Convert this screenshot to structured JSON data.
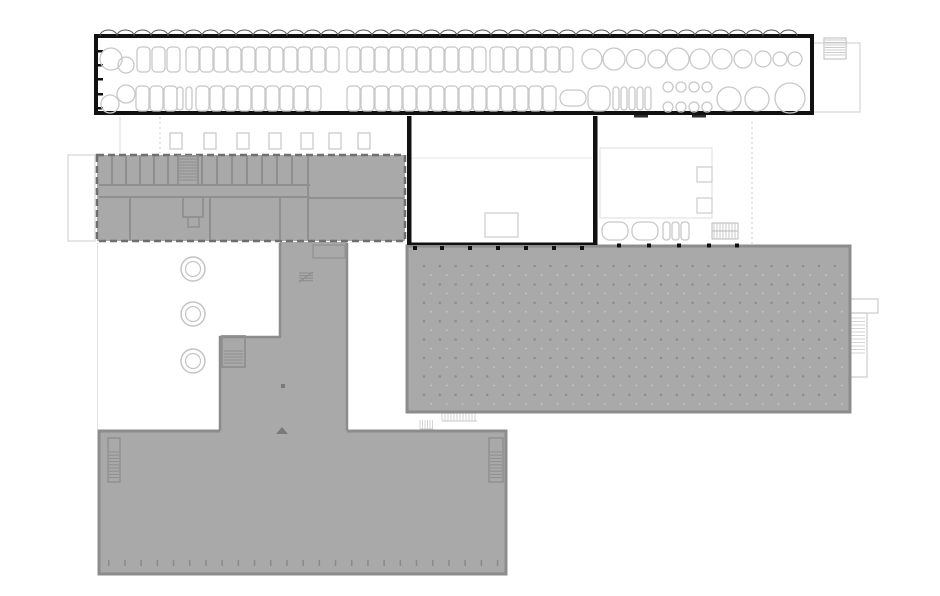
{
  "canvas": {
    "width": 940,
    "height": 596,
    "background": "#ffffff"
  },
  "palette": {
    "bg": "#ffffff",
    "fill_gray": "#a9a9a9",
    "wall_gray": "#8f8f8f",
    "border_gray": "#8c8c8c",
    "dark_dash": "#6f6f6f",
    "black": "#111111",
    "light": "#c8c8c8",
    "faint": "#dedede",
    "dot": "#8e8e8e",
    "dot2": "#c6c6c6",
    "marker": "#7a7a7a"
  },
  "layers": [
    {
      "name": "site-faint-outlines",
      "items": [
        [
          "rect",
          68,
          155,
          27,
          86,
          "#d4d4d4",
          1.2,
          "none"
        ],
        [
          "line",
          97.5,
          243,
          97.5,
          430,
          "#e2e2e2",
          1
        ],
        [
          "line",
          120,
          117,
          120,
          153,
          "#dddddd",
          1
        ],
        [
          "dline",
          160,
          117,
          160,
          153,
          "#cccccc",
          1
        ],
        [
          "sqrow",
          [
            170,
            204,
            237,
            269,
            301,
            329,
            358
          ],
          133,
          12,
          16,
          "#c6c6c6",
          1.2
        ],
        [
          "line",
          409,
          158,
          592,
          158,
          "#e6e6e6",
          1
        ],
        [
          "rect",
          485,
          213,
          33,
          24,
          "#cccccc",
          1.2,
          "none"
        ],
        [
          "rect",
          600,
          148,
          112,
          70,
          "#dddddd",
          1,
          "none"
        ],
        [
          "rect",
          697,
          167,
          15,
          15,
          "#cccccc",
          1.2,
          "none"
        ],
        [
          "rect",
          697,
          198,
          15,
          15,
          "#cccccc",
          1.2,
          "none"
        ],
        [
          "rr",
          602,
          222,
          26,
          18,
          8,
          "#c8c8c8",
          1.3
        ],
        [
          "rr",
          632,
          222,
          26,
          18,
          8,
          "#c8c8c8",
          1.3
        ],
        [
          "rr",
          663,
          222,
          7,
          18,
          3,
          "#c8c8c8",
          1.3
        ],
        [
          "rr",
          672,
          222,
          7,
          18,
          3,
          "#c8c8c8",
          1.3
        ],
        [
          "rr",
          681,
          222,
          8,
          18,
          3,
          "#c8c8c8",
          1.3
        ],
        [
          "rect",
          712,
          223,
          26,
          16,
          "#bbbbbb",
          1,
          "none"
        ],
        [
          "vlines",
          714,
          736,
          3,
          223,
          239,
          "#bbbbbb",
          0.8
        ],
        [
          "line",
          712,
          231,
          738,
          231,
          "#bbbbbb",
          1
        ],
        [
          "dline",
          752,
          122,
          752,
          244,
          "#c8c8c8",
          1
        ],
        [
          "rect",
          812,
          43,
          48,
          69,
          "#d4d4d4",
          1.2,
          "none"
        ],
        [
          "rect",
          824,
          38,
          22,
          21,
          "#bbbbbb",
          1,
          "none"
        ],
        [
          "rungs",
          825,
          845,
          40,
          57,
          2.5,
          "#bbbbbb",
          0.8
        ],
        [
          "rect",
          848,
          299,
          30,
          14,
          "#cccccc",
          1.2,
          "none"
        ],
        [
          "rect",
          848,
          313,
          19,
          64,
          "#cccccc",
          1.2,
          "none"
        ],
        [
          "rungs",
          850,
          865,
          318,
          356,
          3.5,
          "#cccccc",
          0.8
        ],
        [
          "vlines",
          420,
          433,
          2.5,
          420,
          429,
          "#c9c9c9",
          0.8
        ],
        [
          "line",
          420,
          429,
          433,
          429,
          "#c9c9c9",
          1
        ],
        [
          "vlines",
          442,
          477,
          3,
          412,
          421,
          "#c9c9c9",
          0.8
        ],
        [
          "line",
          442,
          412.5,
          477,
          412.5,
          "#c9c9c9",
          1
        ],
        [
          "line",
          442,
          421,
          477,
          421,
          "#c9c9c9",
          1
        ]
      ]
    },
    {
      "name": "south-hall",
      "items": [
        [
          "rect",
          99,
          431,
          407,
          143,
          "#8c8c8c",
          3,
          "#a9a9a9"
        ],
        [
          "rect",
          108,
          438,
          12,
          44,
          "#8f8f8f",
          1.5,
          "none"
        ],
        [
          "rungs",
          109,
          119,
          452,
          479,
          3.2,
          "#8f8f8f",
          1
        ],
        [
          "rect",
          489,
          438,
          14,
          44,
          "#8f8f8f",
          1.5,
          "none"
        ],
        [
          "rungs",
          490,
          502,
          452,
          480,
          3.2,
          "#8f8f8f",
          1
        ],
        [
          "vticks",
          108,
          16.2,
          25,
          560,
          6,
          1.5,
          "#8a8a8a"
        ]
      ]
    },
    {
      "name": "east-production-hall",
      "items": [
        [
          "rect",
          407,
          246,
          443,
          166,
          "#8c8c8c",
          3,
          "#a9a9a9"
        ],
        [
          "dots",
          424,
          266,
          15.8,
          18.4,
          27,
          8,
          1.3,
          "#8e8e8e",
          0.9,
          "#c6c6c6",
          7,
          9
        ]
      ]
    },
    {
      "name": "central-spine-wing",
      "items": [
        [
          "poly",
          "280,242 347,242 347,435 220,435 220,337 280,337",
          "none",
          0,
          "#a9a9a9"
        ],
        [
          "path",
          "M347,243 L347,431",
          "#8c8c8c",
          2.5
        ],
        [
          "path",
          "M280,243 L280,337 L220,337 L220,431",
          "#8c8c8c",
          2.5
        ],
        [
          "rect",
          222,
          336,
          23,
          31,
          "#8f8f8f",
          1.8,
          "none"
        ],
        [
          "rungs",
          224,
          243,
          351,
          365,
          3,
          "#8f8f8f",
          1
        ],
        [
          "rungs",
          299,
          313,
          273,
          281,
          2.6,
          "#8a8a8a",
          1
        ],
        [
          "line",
          299,
          282,
          313,
          272,
          "#8a8a8a",
          1
        ],
        [
          "rect",
          313,
          245,
          32,
          13,
          "#949494",
          1.4,
          "none"
        ],
        [
          "rect",
          281,
          384,
          4,
          4,
          "none",
          0,
          "#7a7a7a"
        ],
        [
          "poly",
          "276,434 288,434 282,427",
          "none",
          0,
          "#7a7a7a"
        ]
      ]
    },
    {
      "name": "north-office-building",
      "items": [
        [
          "drect",
          97,
          155,
          308,
          86,
          "#6f6f6f",
          2.5,
          "#a9a9a9",
          "7 4"
        ],
        [
          "line",
          99,
          185,
          310,
          185,
          "#8f8f8f",
          2
        ],
        [
          "line",
          99,
          197,
          310,
          197,
          "#8f8f8f",
          2
        ],
        [
          "line",
          308,
          198,
          404,
          198,
          "#8f8f8f",
          2
        ],
        [
          "vlines2",
          [
            112,
            126,
            140,
            154,
            168,
            202,
            217,
            232,
            247,
            262,
            277,
            292
          ],
          156,
          185,
          "#8f8f8f",
          2
        ],
        [
          "rect",
          178,
          156,
          20,
          29,
          "#8f8f8f",
          1.8,
          "none"
        ],
        [
          "rungs",
          179,
          197,
          159,
          182,
          3,
          "#8f8f8f",
          1
        ],
        [
          "line",
          308,
          156,
          308,
          240,
          "#8f8f8f",
          2
        ],
        [
          "vlines2",
          [
            130,
            210,
            280
          ],
          198,
          240,
          "#8f8f8f",
          2
        ],
        [
          "rect",
          183,
          197,
          20,
          20,
          "#8f8f8f",
          1.8,
          "none"
        ],
        [
          "rect",
          188,
          217,
          11,
          10,
          "#8f8f8f",
          1.5,
          "none"
        ]
      ]
    },
    {
      "name": "courtyard-trees",
      "items": [
        [
          "circle",
          193,
          269,
          12,
          "#c4c4c4",
          1.5,
          "none"
        ],
        [
          "circle",
          193,
          269,
          7.5,
          "#c4c4c4",
          1.2,
          "none"
        ],
        [
          "circle",
          193,
          314,
          12,
          "#c4c4c4",
          1.5,
          "none"
        ],
        [
          "circle",
          193,
          314,
          7.5,
          "#c4c4c4",
          1.2,
          "none"
        ],
        [
          "circle",
          193,
          361,
          12,
          "#c4c4c4",
          1.5,
          "none"
        ],
        [
          "circle",
          193,
          361,
          7.5,
          "#c4c4c4",
          1.2,
          "none"
        ]
      ]
    },
    {
      "name": "courtyard-black-walls",
      "items": [
        [
          "rect",
          407,
          116,
          4.5,
          129,
          "none",
          0,
          "#111111"
        ],
        [
          "rect",
          593,
          116,
          4.5,
          129,
          "none",
          0,
          "#111111"
        ],
        [
          "rect",
          407,
          242.5,
          190,
          2.5,
          "none",
          0,
          "#111111"
        ],
        [
          "hticks",
          [
            413,
            440,
            468,
            496,
            524,
            552,
            580
          ],
          246,
          4,
          4,
          "#111111"
        ],
        [
          "hticks",
          [
            617,
            647,
            677,
            707,
            735
          ],
          243.5,
          4,
          4,
          "#111111"
        ],
        [
          "rect",
          634,
          115,
          14,
          2.5,
          "none",
          0,
          "#2a2a2a"
        ],
        [
          "rect",
          692,
          115,
          14,
          2.5,
          "none",
          0,
          "#2a2a2a"
        ]
      ]
    },
    {
      "name": "north-parking-strip",
      "items": [
        [
          "rect",
          96,
          36,
          716,
          77,
          "#111111",
          4,
          "#ffffff"
        ],
        [
          "scallops",
          100,
          808,
          36,
          8.5,
          6,
          "#555555",
          1
        ],
        [
          "hticks2",
          97,
          [
            50,
            64,
            78,
            93,
            107
          ],
          6,
          2.5,
          "#111111"
        ],
        [
          "shapes",
          [
            [
              "c",
              111,
              59,
              11
            ],
            [
              "c",
              126,
              65,
              8
            ],
            [
              "c",
              592,
              59,
              10
            ],
            [
              "c",
              614,
              59,
              11
            ],
            [
              "c",
              636,
              59,
              9.5
            ],
            [
              "c",
              657,
              59,
              9
            ],
            [
              "c",
              678,
              59,
              11
            ],
            [
              "c",
              700,
              59,
              10
            ],
            [
              "c",
              722,
              59,
              10
            ],
            [
              "c",
              743,
              59,
              9
            ],
            [
              "c",
              763,
              59,
              8
            ],
            [
              "c",
              780,
              59,
              7
            ],
            [
              "c",
              795,
              59,
              7
            ],
            [
              "c",
              126,
              94,
              9
            ],
            [
              "c",
              110,
              104,
              9
            ],
            [
              "rr",
              177,
              87,
              6,
              23,
              3
            ],
            [
              "rr",
              186,
              87,
              6,
              23,
              3
            ],
            [
              "rr",
              560,
              90,
              26,
              16,
              8
            ],
            [
              "rr",
              588,
              86,
              22,
              25,
              8
            ],
            [
              "rr",
              613,
              87,
              6,
              23,
              3
            ],
            [
              "rr",
              621,
              87,
              6,
              23,
              3
            ],
            [
              "rr",
              629,
              87,
              6,
              23,
              3
            ],
            [
              "rr",
              637,
              87,
              6,
              23,
              3
            ],
            [
              "rr",
              645,
              87,
              6,
              23,
              3
            ],
            [
              "c",
              668,
              87,
              5
            ],
            [
              "c",
              681,
              87,
              5
            ],
            [
              "c",
              694,
              87,
              5
            ],
            [
              "c",
              707,
              87,
              5
            ],
            [
              "c",
              668,
              107,
              5
            ],
            [
              "c",
              681,
              107,
              5
            ],
            [
              "c",
              694,
              107,
              5
            ],
            [
              "c",
              707,
              107,
              5
            ],
            [
              "c",
              729,
              99,
              12
            ],
            [
              "c",
              757,
              99,
              12
            ],
            [
              "c",
              790,
              98,
              15
            ]
          ],
          "#c8c8c8",
          1.3
        ],
        [
          "carrow",
          [
            137,
            152,
            167,
            186,
            200,
            214,
            228,
            242,
            256,
            270,
            284,
            298,
            312,
            326,
            347,
            361,
            375,
            389,
            403,
            417,
            431,
            445,
            459,
            473,
            490,
            504,
            518,
            532,
            546,
            560
          ],
          47,
          13,
          25,
          4,
          "#c8c8c8",
          1.3
        ],
        [
          "carrow",
          [
            136,
            150,
            164,
            196,
            210,
            224,
            238,
            252,
            266,
            280,
            294,
            308,
            347,
            361,
            375,
            389,
            403,
            417,
            431,
            445,
            459,
            473,
            487,
            501,
            515,
            529,
            543
          ],
          86,
          13,
          25,
          4,
          "#c8c8c8",
          1.3
        ]
      ]
    }
  ]
}
